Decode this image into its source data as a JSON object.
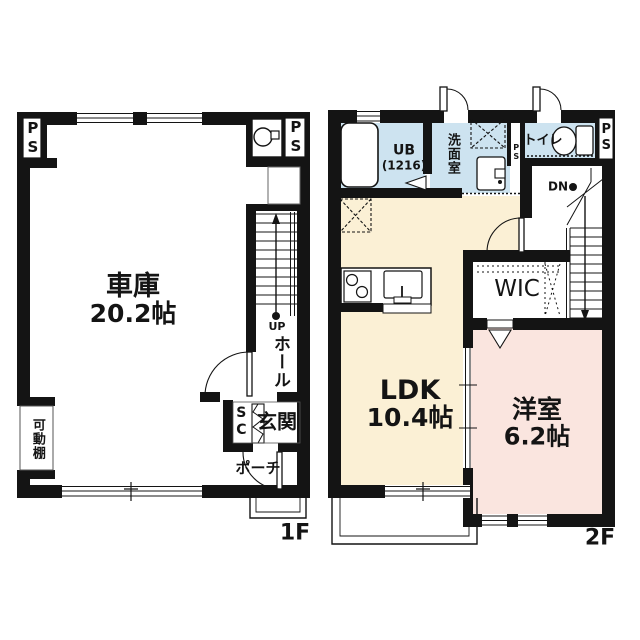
{
  "drawing": {
    "type": "floor-plan",
    "colors": {
      "wall": "#141414",
      "wet_room": "#cde3f0",
      "ldk": "#fbf0d5",
      "bedroom": "#fae5df",
      "paper": "#ffffff"
    },
    "f1": {
      "label": "1F",
      "garage": {
        "name": "車庫",
        "size": "20.2帖"
      },
      "movable_shelf": "可動棚",
      "hall": "ホール",
      "entrance": "玄関",
      "porch": "ポーチ",
      "shoe_closet": "SC",
      "stairs": "UP",
      "ps_left": "PS",
      "ps_right": "PS"
    },
    "f2": {
      "label": "2F",
      "ldk": {
        "name": "LDK",
        "size": "10.4帖"
      },
      "bedroom": {
        "name": "洋室",
        "size": "6.2帖"
      },
      "wic": "WIC",
      "unit_bath": {
        "name": "UB",
        "size": "(1216)"
      },
      "washroom": "洗面室",
      "toilet": "トイレ",
      "stairs": "DN",
      "ps_shaft": "PS",
      "ps_right": "PS"
    }
  }
}
